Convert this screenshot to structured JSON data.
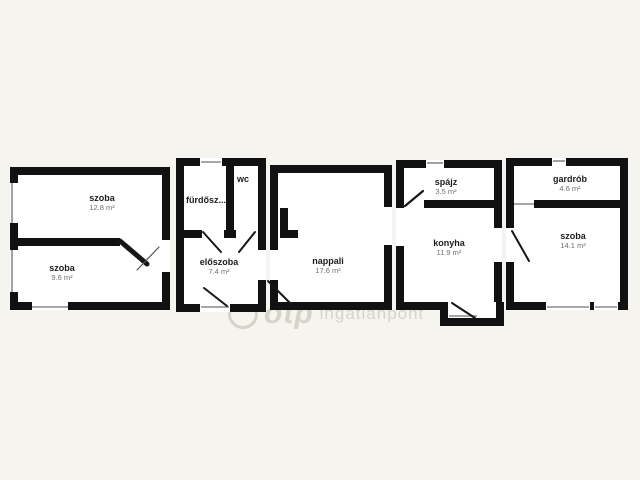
{
  "image": {
    "type": "apartment floor plan",
    "background_color": "#f6f4ef",
    "wall_color": "#111111",
    "room_fill_color": "#ffffff"
  },
  "rooms": [
    {
      "id": "szoba-1",
      "label": "szoba",
      "area": "12.8 m²"
    },
    {
      "id": "szoba-2",
      "label": "szoba",
      "area": "9.6 m²"
    },
    {
      "id": "furdoszoba",
      "label": "fürdősz...",
      "area": ""
    },
    {
      "id": "wc",
      "label": "wc",
      "area": ""
    },
    {
      "id": "eloszoba",
      "label": "előszoba",
      "area": "7.4 m²"
    },
    {
      "id": "nappali",
      "label": "nappali",
      "area": "17.6 m²"
    },
    {
      "id": "spajz",
      "label": "spájz",
      "area": "3.5 m²"
    },
    {
      "id": "konyha",
      "label": "konyha",
      "area": "11.9 m²"
    },
    {
      "id": "gardrob",
      "label": "gardrób",
      "area": "4.6 m²"
    },
    {
      "id": "szoba-3",
      "label": "szoba",
      "area": "14.1 m²"
    }
  ],
  "watermark": {
    "brand": "otp",
    "suffix": "ingatlanpont"
  }
}
